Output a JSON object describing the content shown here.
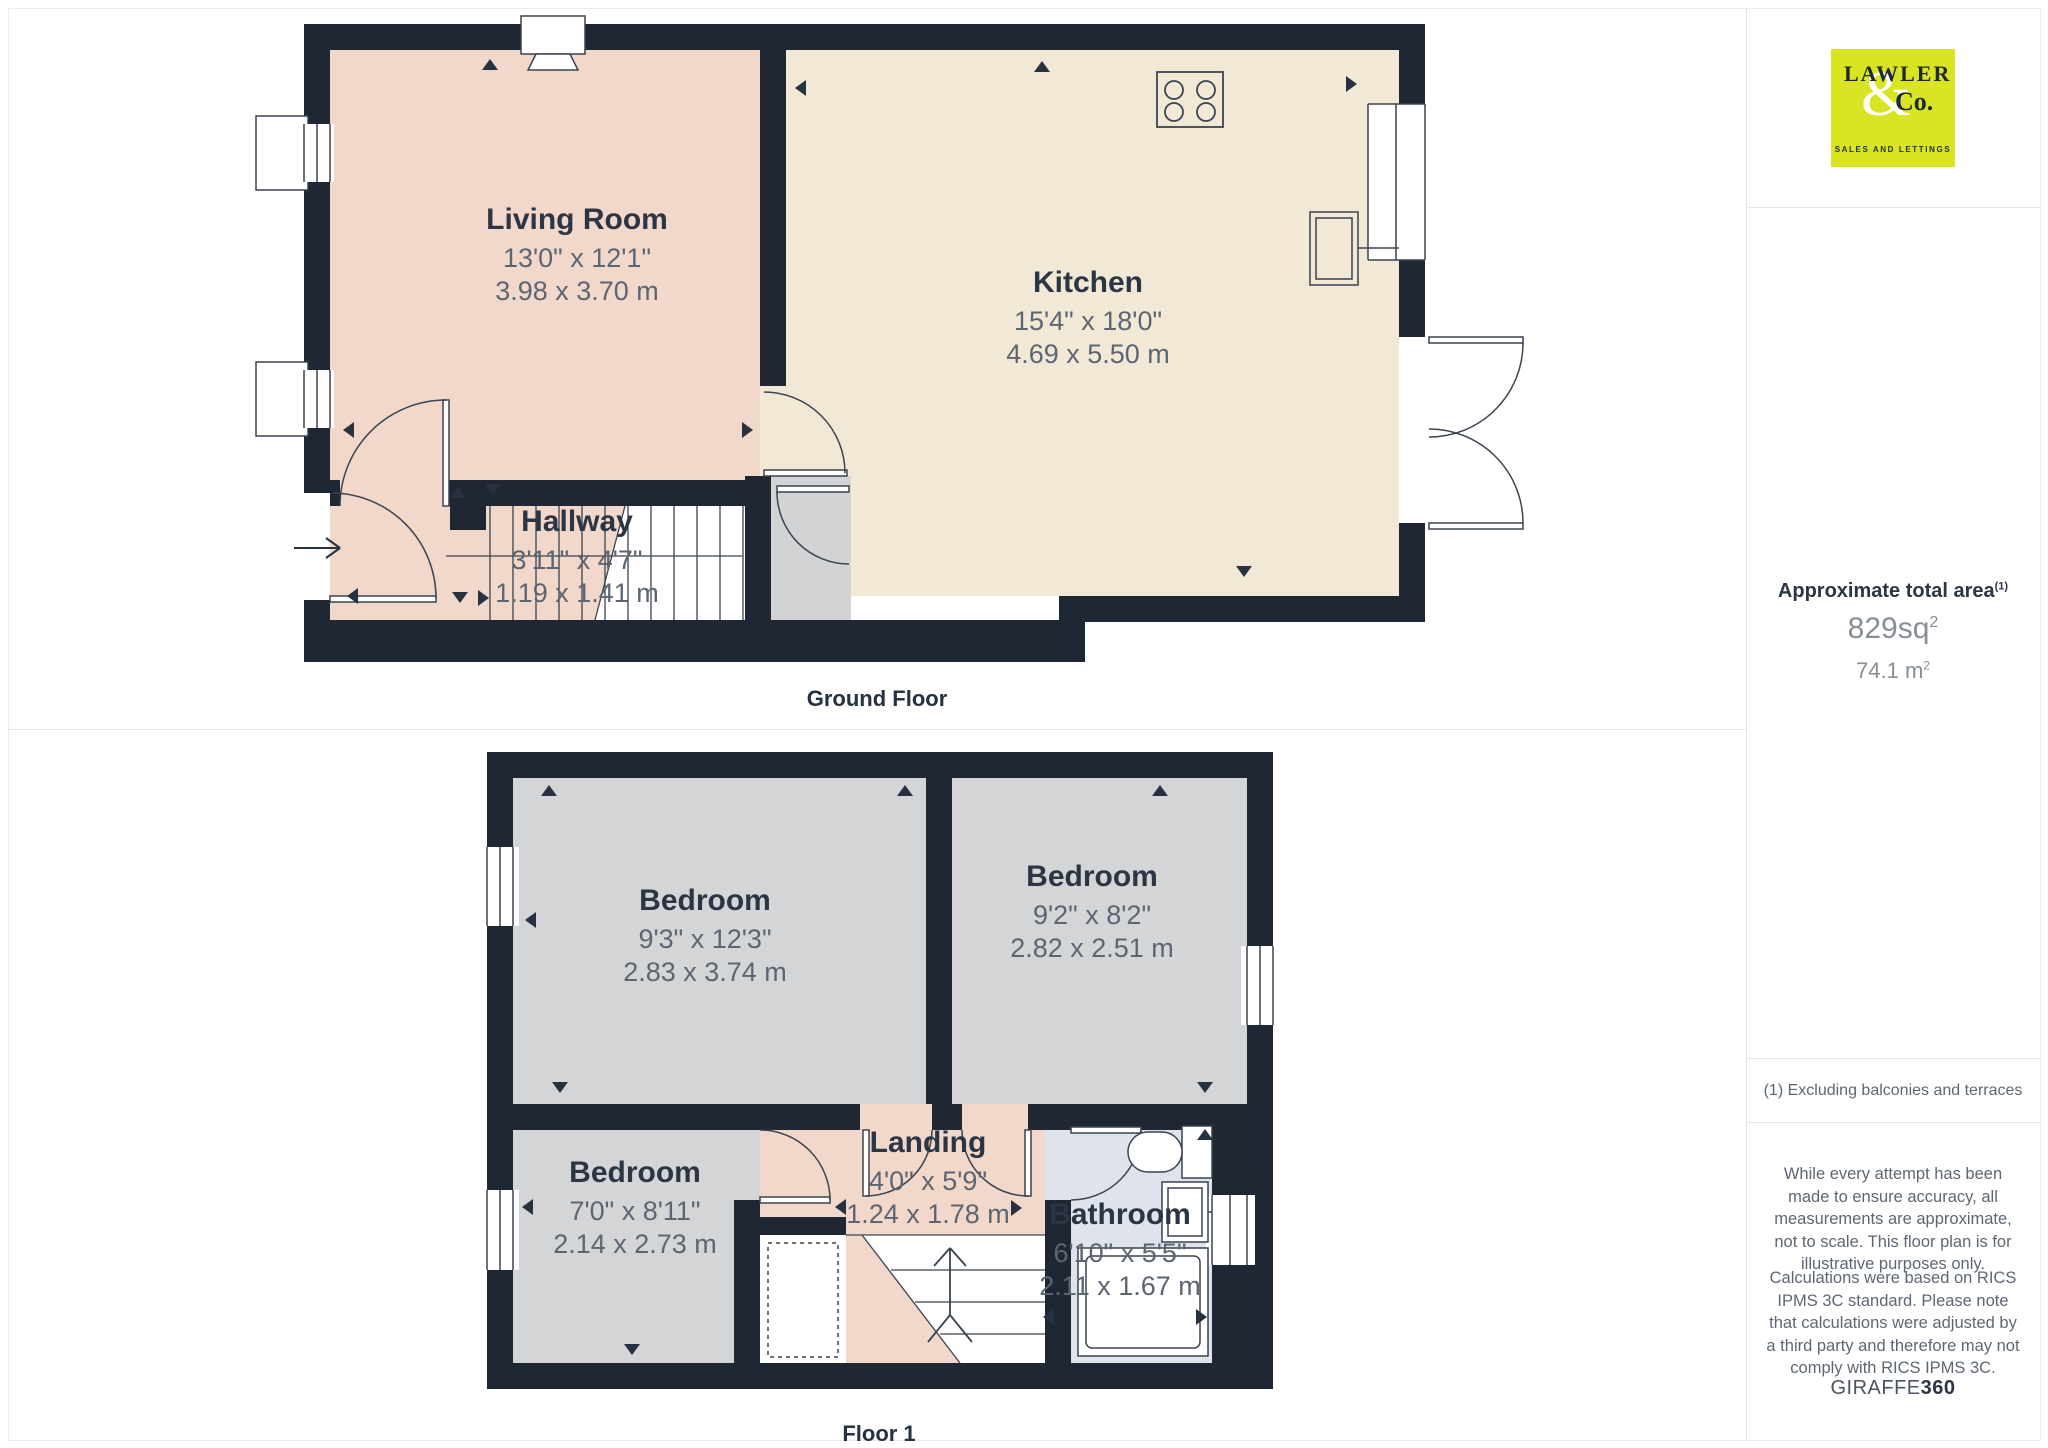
{
  "floors": {
    "ground": {
      "caption": "Ground Floor",
      "rooms": {
        "living": {
          "name": "Living Room",
          "imperial": "13'0\" x 12'1\"",
          "metric": "3.98 x 3.70 m"
        },
        "kitchen": {
          "name": "Kitchen",
          "imperial": "15'4\" x 18'0\"",
          "metric": "4.69 x 5.50 m"
        },
        "hallway": {
          "name": "Hallway",
          "imperial": "3'11\" x 4'7\"",
          "metric": "1.19 x 1.41 m"
        }
      }
    },
    "first": {
      "caption": "Floor 1",
      "rooms": {
        "bedroom1": {
          "name": "Bedroom",
          "imperial": "9'3\" x 12'3\"",
          "metric": "2.83 x 3.74 m"
        },
        "bedroom2": {
          "name": "Bedroom",
          "imperial": "9'2\" x 8'2\"",
          "metric": "2.82 x 2.51 m"
        },
        "bedroom3": {
          "name": "Bedroom",
          "imperial": "7'0\" x 8'11\"",
          "metric": "2.14 x 2.73 m"
        },
        "landing": {
          "name": "Landing",
          "imperial": "4'0\" x 5'9\"",
          "metric": "1.24 x 1.78 m"
        },
        "bathroom": {
          "name": "Bathroom",
          "imperial": "6'10\" x 5'5\"",
          "metric": "2.11 x 1.67 m"
        }
      }
    }
  },
  "sidebar": {
    "logo": {
      "word": "LAWLER",
      "amp": "&",
      "co": "Co.",
      "tagline": "SALES AND LETTINGS"
    },
    "area": {
      "title": "Approximate total area",
      "title_sup": "(1)",
      "imperial_value": "829sq",
      "imperial_sup": "2",
      "metric_value": "74.1 m",
      "metric_sup": "2"
    },
    "footnote": "(1) Excluding balconies and terraces",
    "disclaimer1": "While every attempt has been made to ensure accuracy, all measurements are approximate, not to scale. This floor plan is for illustrative purposes only.",
    "disclaimer2": "Calculations were based on RICS IPMS 3C standard. Please note that calculations were adjusted by a third party and therefore may not comply with RICS IPMS 3C.",
    "brand_name": "GIRAFFE",
    "brand_bold": "360"
  },
  "colors": {
    "wall": "#1e2733",
    "living_pink": "#f2d8cb",
    "kitchen_cream": "#f1e9d6",
    "bedroom_grey": "#d4d5d7",
    "bathroom_blue": "#dfe3ec",
    "logo_green": "#d9e522"
  }
}
